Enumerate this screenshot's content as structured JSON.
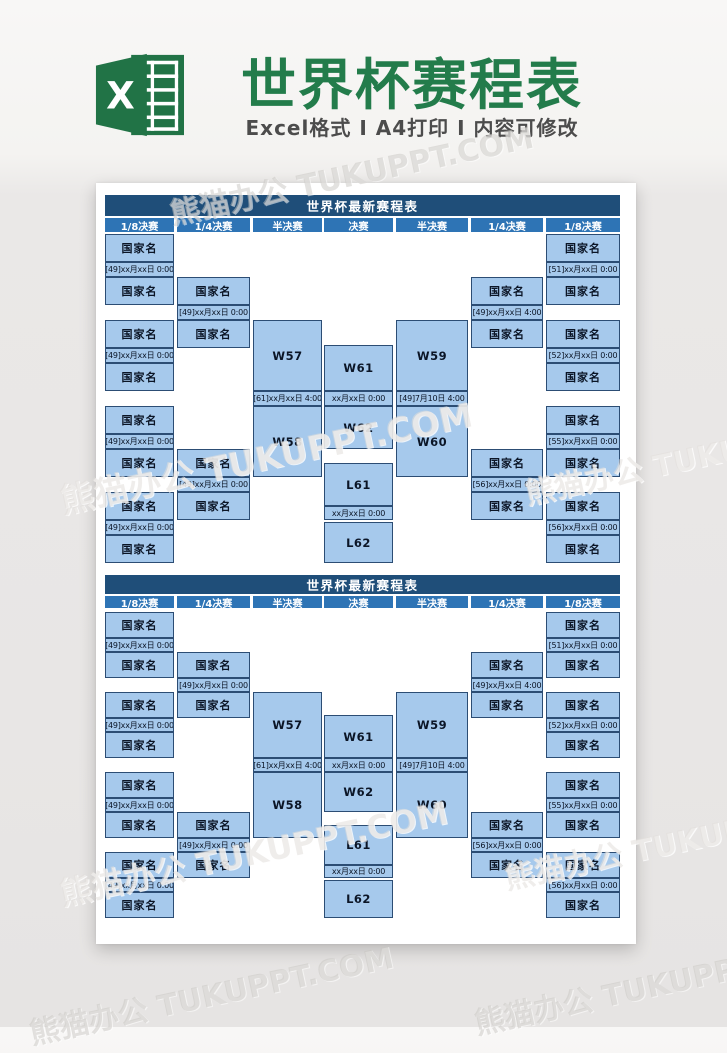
{
  "banner": {
    "logo_letter": "X",
    "title": "世界杯赛程表",
    "subtitle": "Excel格式 Ⅰ A4打印 Ⅰ 内容可修改"
  },
  "watermark": {
    "text": "熊猫办公 TUKUPPT.COM"
  },
  "colors": {
    "green": "#237c4b",
    "navy": "#1f4e79",
    "hblue": "#2e74b5",
    "cellblue": "#a6c9ec",
    "cellborder": "#2c4d74"
  },
  "tables": [
    {
      "title": "世界杯最新赛程表",
      "columns": [
        "1/8决赛",
        "1/4决赛",
        "半决赛",
        "决赛",
        "半决赛",
        "1/4决赛",
        "1/8决赛"
      ],
      "octo_left": [
        {
          "top": "国家名",
          "date": "[49]xx月xx日 0:00",
          "bottom": "国家名"
        },
        {
          "top": "国家名",
          "date": "[49]xx月xx日 0:00",
          "bottom": "国家名"
        },
        {
          "top": "国家名",
          "date": "[49]xx月xx日 0:00",
          "bottom": "国家名"
        },
        {
          "top": "国家名",
          "date": "[49]xx月xx日 0:00",
          "bottom": "国家名"
        }
      ],
      "quarter_left": [
        {
          "top": "国家名",
          "date": "[49]xx月xx日 0:00",
          "bottom": "国家名"
        },
        {
          "top": "国家名",
          "date": "[49]xx月xx日 0:00",
          "bottom": "国家名"
        }
      ],
      "semi_left": {
        "top": "W57",
        "date": "[61]xx月xx日 4:00",
        "bottom": "W58"
      },
      "final_block": {
        "top": "W61",
        "date": "xx月xx日 0:00",
        "bottom": "W62"
      },
      "third_place": {
        "top": "L61",
        "date": "xx月xx日 0:00",
        "bottom": "L62"
      },
      "semi_right": {
        "top": "W59",
        "date": "[49]7月10日 4:00",
        "bottom": "W60"
      },
      "quarter_right": [
        {
          "top": "国家名",
          "date": "[49]xx月xx日 4:00",
          "bottom": "国家名"
        },
        {
          "top": "国家名",
          "date": "[56]xx月xx日 0:00",
          "bottom": "国家名"
        }
      ],
      "octo_right": [
        {
          "top": "国家名",
          "date": "[51]xx月xx日 0:00",
          "bottom": "国家名"
        },
        {
          "top": "国家名",
          "date": "[52]xx月xx日 0:00",
          "bottom": "国家名"
        },
        {
          "top": "国家名",
          "date": "[55]xx月xx日 0:00",
          "bottom": "国家名"
        },
        {
          "top": "国家名",
          "date": "[56]xx月xx日 0:00",
          "bottom": "国家名"
        }
      ]
    },
    {
      "title": "世界杯最新赛程表",
      "columns": [
        "1/8决赛",
        "1/4决赛",
        "半决赛",
        "决赛",
        "半决赛",
        "1/4决赛",
        "1/8决赛"
      ],
      "octo_left": [
        {
          "top": "国家名",
          "date": "[49]xx月xx日 0:00",
          "bottom": "国家名"
        },
        {
          "top": "国家名",
          "date": "[49]xx月xx日 0:00",
          "bottom": "国家名"
        },
        {
          "top": "国家名",
          "date": "[49]xx月xx日 0:00",
          "bottom": "国家名"
        },
        {
          "top": "国家名",
          "date": "[49]xx月xx日 0:00",
          "bottom": "国家名"
        }
      ],
      "quarter_left": [
        {
          "top": "国家名",
          "date": "[49]xx月xx日 0:00",
          "bottom": "国家名"
        },
        {
          "top": "国家名",
          "date": "[49]xx月xx日 0:00",
          "bottom": "国家名"
        }
      ],
      "semi_left": {
        "top": "W57",
        "date": "[61]xx月xx日 4:00",
        "bottom": "W58"
      },
      "final_block": {
        "top": "W61",
        "date": "xx月xx日 0:00",
        "bottom": "W62"
      },
      "third_place": {
        "top": "L61",
        "date": "xx月xx日 0:00",
        "bottom": "L62"
      },
      "semi_right": {
        "top": "W59",
        "date": "[49]7月10日 4:00",
        "bottom": "W60"
      },
      "quarter_right": [
        {
          "top": "国家名",
          "date": "[49]xx月xx日 4:00",
          "bottom": "国家名"
        },
        {
          "top": "国家名",
          "date": "[56]xx月xx日 0:00",
          "bottom": "国家名"
        }
      ],
      "octo_right": [
        {
          "top": "国家名",
          "date": "[51]xx月xx日 0:00",
          "bottom": "国家名"
        },
        {
          "top": "国家名",
          "date": "[52]xx月xx日 0:00",
          "bottom": "国家名"
        },
        {
          "top": "国家名",
          "date": "[55]xx月xx日 0:00",
          "bottom": "国家名"
        },
        {
          "top": "国家名",
          "date": "[56]xx月xx日 0:00",
          "bottom": "国家名"
        }
      ]
    }
  ]
}
